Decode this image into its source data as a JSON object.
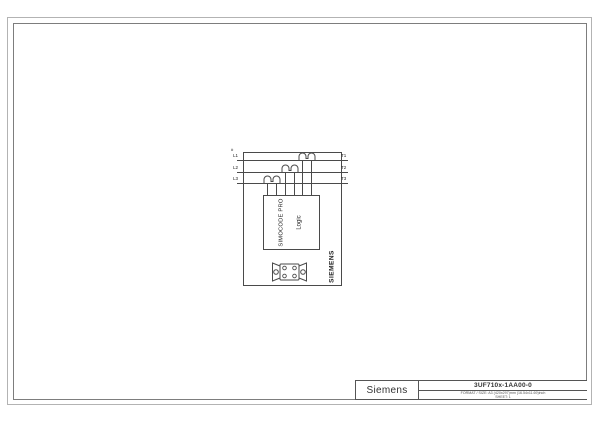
{
  "title_block": {
    "manufacturer": "Siemens",
    "part_number": "3UF710x-1AA00-0",
    "format_line": "FORMAT / SIZE: A3 (420x297)mm (16.54x11.69)inch",
    "sheet_line": "SHEET: 1"
  },
  "diagram": {
    "note_mark": "#",
    "phase_inputs": [
      "L1",
      "L2",
      "L3"
    ],
    "phase_outputs": [
      "T1",
      "T2",
      "T3"
    ],
    "device_line1": "SIMOCODE PRO",
    "device_line2": "Logic",
    "brand": "SIEMENS"
  },
  "colors": {
    "line": "#4a4a4a",
    "frame_outer": "#b3b3b3",
    "frame_inner": "#7d7d7d",
    "text": "#222222",
    "background": "#ffffff"
  }
}
